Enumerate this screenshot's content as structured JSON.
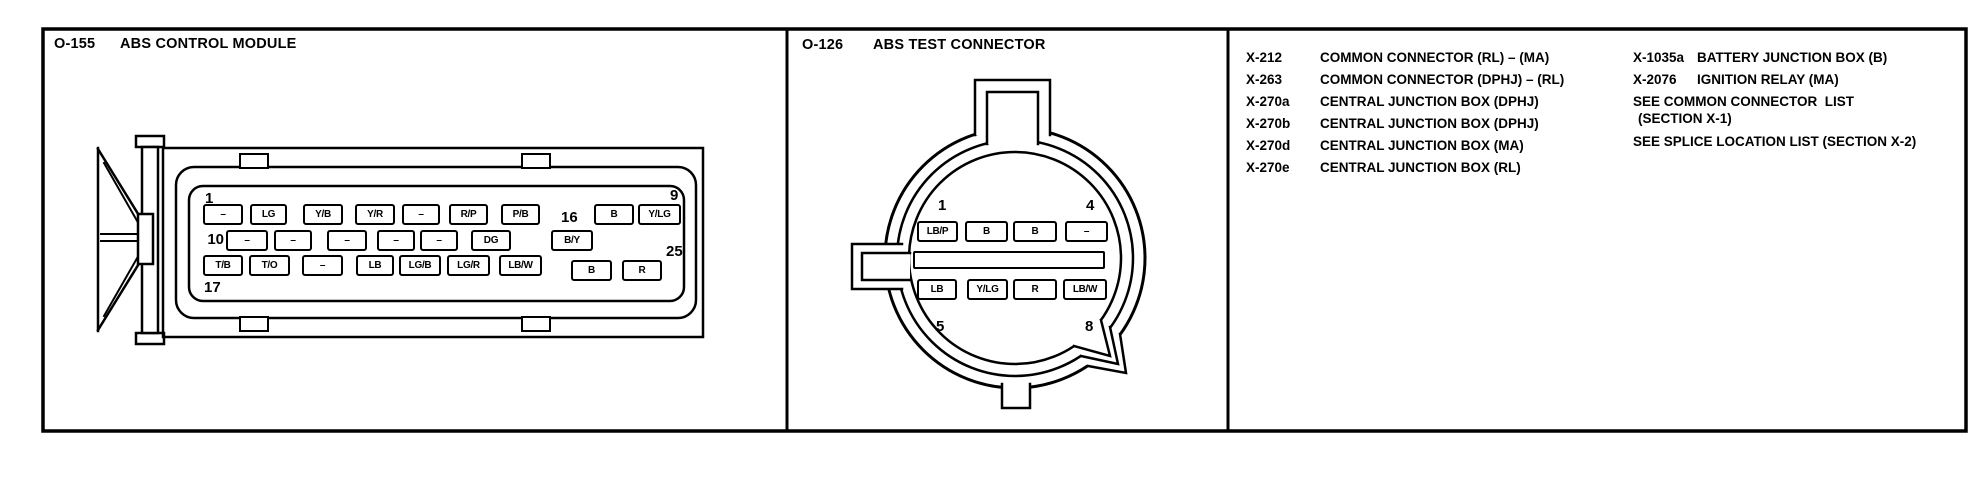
{
  "colors": {
    "ink": "#000000",
    "paper": "#ffffff"
  },
  "abs_module": {
    "code": "O-155",
    "title": "ABS CONTROL MODULE",
    "pin_rows": [
      [
        "–",
        "LG",
        "Y/B",
        "Y/R",
        "–",
        "R/P",
        "P/B",
        "B",
        "Y/LG"
      ],
      [
        "–",
        "–",
        "–",
        "–",
        "–",
        "DG",
        "B/Y"
      ],
      [
        "T/B",
        "T/O",
        "–",
        "LB",
        "LG/B",
        "LG/R",
        "LB/W",
        "B",
        "R"
      ]
    ],
    "pin_numbers": {
      "p1": "1",
      "p9": "9",
      "p10": "10",
      "p16": "16",
      "p17": "17",
      "p25": "25"
    }
  },
  "test_connector": {
    "code": "O-126",
    "title": "ABS TEST CONNECTOR",
    "pin_rows": [
      [
        "LB/P",
        "B",
        "B",
        "–"
      ],
      [
        "LB",
        "Y/LG",
        "R",
        "LB/W"
      ]
    ],
    "pin_numbers": {
      "p1": "1",
      "p4": "4",
      "p5": "5",
      "p8": "8"
    }
  },
  "reference_list": {
    "column1": [
      {
        "code": "X-212",
        "name": "COMMON CONNECTOR (RL) – (MA)"
      },
      {
        "code": "X-263",
        "name": "COMMON CONNECTOR (DPHJ) – (RL)"
      },
      {
        "code": "X-270a",
        "name": "CENTRAL JUNCTION BOX (DPHJ)"
      },
      {
        "code": "X-270b",
        "name": "CENTRAL JUNCTION BOX (DPHJ)"
      },
      {
        "code": "X-270d",
        "name": "CENTRAL JUNCTION BOX (MA)"
      },
      {
        "code": "X-270e",
        "name": "CENTRAL JUNCTION BOX (RL)"
      }
    ],
    "column2": [
      {
        "code": "X-1035a",
        "name": "BATTERY JUNCTION BOX (B)"
      },
      {
        "code": "X-2076",
        "name": "IGNITION RELAY (MA)"
      }
    ],
    "notes": [
      "SEE COMMON CONNECTOR  LIST",
      "(SECTION X-1)",
      "SEE SPLICE LOCATION LIST (SECTION X-2)"
    ]
  }
}
